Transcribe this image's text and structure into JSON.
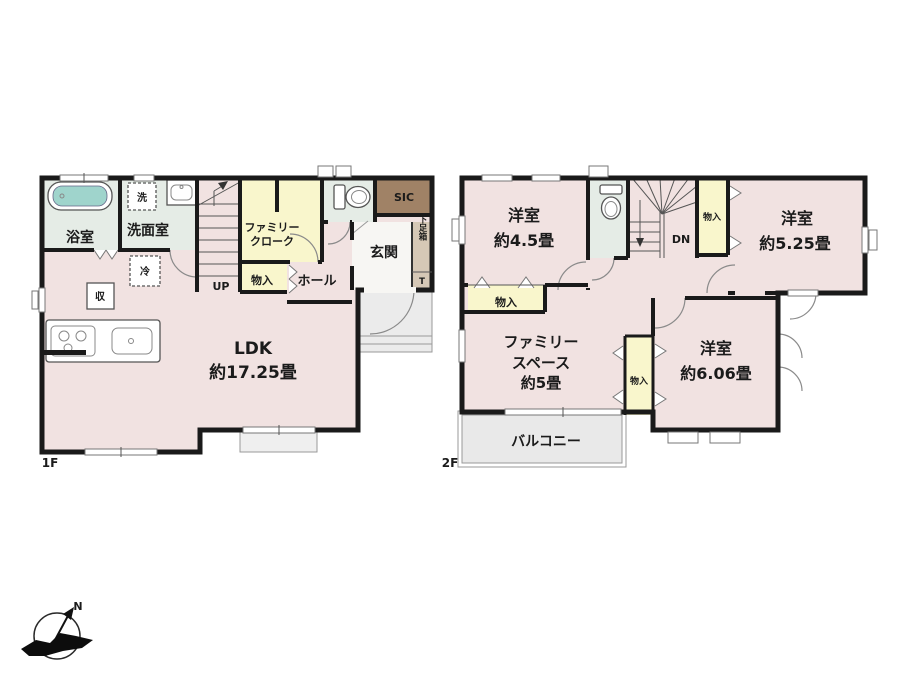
{
  "f1": {
    "floor_label": "1F",
    "bath": "浴室",
    "washroom": "洗面室",
    "washer": "洗",
    "fridge": "冷",
    "storage": "収",
    "family_closet_l1": "ファミリー",
    "family_closet_l2": "クローク",
    "closet": "物入",
    "hall": "ホール",
    "up": "UP",
    "entrance": "玄関",
    "sic": "SIC",
    "shoe_box": "下足箱",
    "shoe_box_t": "T",
    "ldk_name": "LDK",
    "ldk_size": "約17.25畳"
  },
  "f2": {
    "floor_label": "2F",
    "bedroom_small_name": "洋室",
    "bedroom_small_size": "約4.5畳",
    "bedroom_mid_name": "洋室",
    "bedroom_mid_size": "約5.25畳",
    "bedroom_large_name": "洋室",
    "bedroom_large_size": "約6.06畳",
    "family_space_l1": "ファミリー",
    "family_space_l2": "スペース",
    "family_space_l3": "約5畳",
    "closet_top": "物入",
    "closet_mid": "物入",
    "closet_left": "物入",
    "dn": "DN",
    "balcony": "バルコニー"
  },
  "compass": {
    "north": "N"
  },
  "colors": {
    "wall": "#1a1a1a",
    "room_floor": "#f1e2e1",
    "closet": "#f9f6cc",
    "wet_area": "#e5ece6",
    "sic": "#a08266",
    "shoe_cabinet": "#d6c8b6",
    "bathtub": "#9fd4cc",
    "balcony": "#e9e9e9",
    "entrance_floor": "#f7f6f3"
  }
}
